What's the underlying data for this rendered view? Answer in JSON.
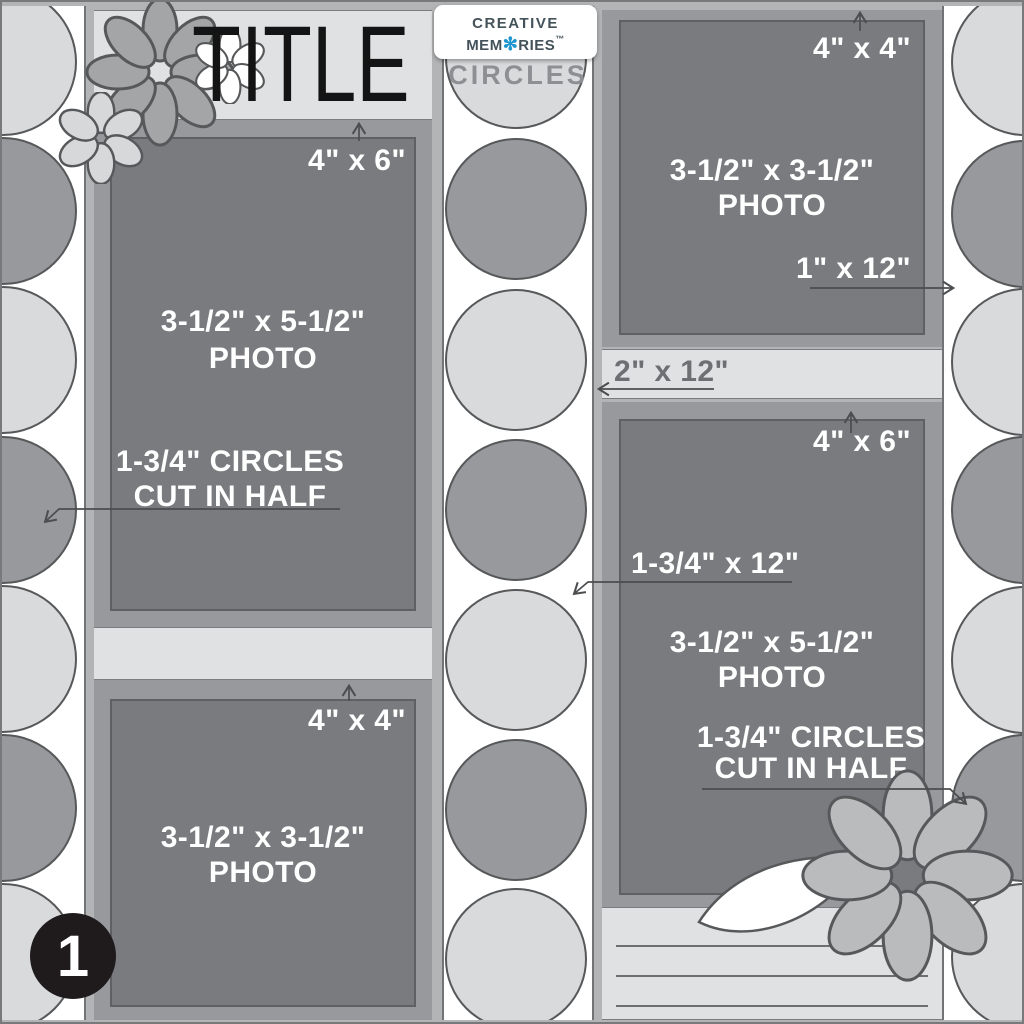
{
  "banner": {
    "title": "TITLE"
  },
  "logo": {
    "word1": "creative",
    "word2_pre": "mem",
    "word2_post": "ries",
    "trademark": "™",
    "flower_glyph": "✻",
    "subtitle": "CIRCLES"
  },
  "badge": {
    "number": "1"
  },
  "left_top": {
    "mat_size": "4\" x 6\"",
    "photo_line1": "3-1/2\" x 5-1/2\"",
    "photo_line2": "PHOTO",
    "note_line1": "1-3/4\" CIRCLES",
    "note_line2": "CUT IN HALF"
  },
  "left_bottom": {
    "mat_size": "4\" x 4\"",
    "photo_line1": "3-1/2\" x 3-1/2\"",
    "photo_line2": "PHOTO"
  },
  "right_top": {
    "mat_size": "4\" x 4\"",
    "photo_line1": "3-1/2\" x 3-1/2\"",
    "photo_line2": "PHOTO",
    "side_strip_label": "1\" x 12\""
  },
  "right_middle_strip": {
    "label": "2\" x 12\""
  },
  "right_bottom": {
    "mat_size": "4\" x 6\"",
    "strip_label": "1-3/4\" x 12\"",
    "photo_line1": "3-1/2\" x 5-1/2\"",
    "photo_line2": "PHOTO",
    "note_line1": "1-3/4\" CIRCLES",
    "note_line2": "CUT IN HALF"
  },
  "colors": {
    "background_sliver": "#b2b4b6",
    "mat_gray": "#97999c",
    "photo_gray": "#797b7e",
    "light_gray": "#dfe1e2",
    "circle_light": "#d9dadc",
    "circle_dark": "#97999c",
    "outline": "#56585a",
    "logo_slate": "#44525a",
    "logo_blue": "#2096ce",
    "badge_black": "#1f1a1c"
  }
}
